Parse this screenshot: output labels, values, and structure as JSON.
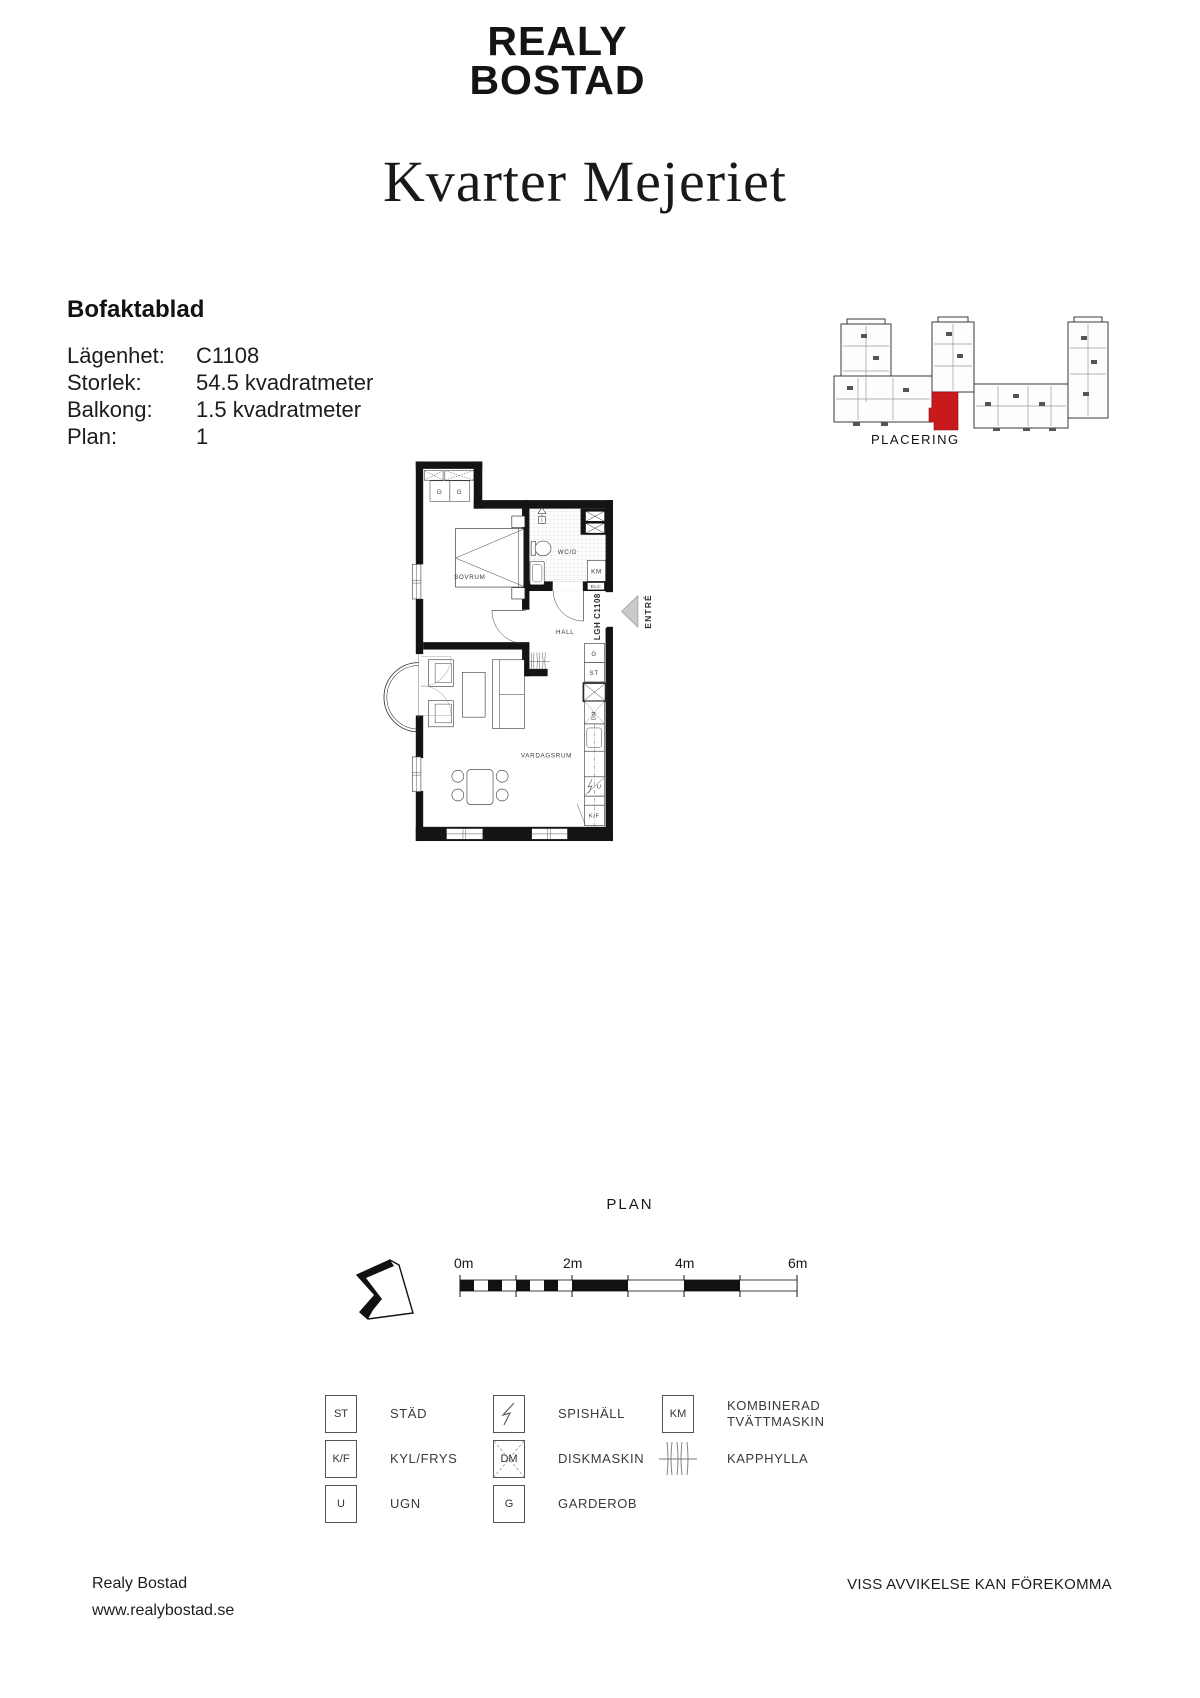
{
  "page": {
    "background": "#ffffff",
    "ink": "#111111",
    "accent_red": "#c8191c"
  },
  "header": {
    "logo_line1": "REALY",
    "logo_line2": "BOSTAD",
    "title": "Kvarter Mejeriet"
  },
  "factsheet": {
    "heading": "Bofaktablad",
    "rows": [
      {
        "label": "Lägenhet:",
        "value": "C1108"
      },
      {
        "label": "Storlek:",
        "value": "54.5 kvadratmeter"
      },
      {
        "label": "Balkong:",
        "value": "1.5 kvadratmeter"
      },
      {
        "label": "Plan:",
        "value": "1"
      }
    ]
  },
  "placement": {
    "caption": "PLACERING"
  },
  "plan": {
    "caption": "PLAN",
    "room_labels": {
      "bedroom": "SOVRUM",
      "bathroom": "WC/D",
      "hall": "HALL",
      "living_room": "VARDAGSRUM"
    },
    "unit_label": "LGH C1108",
    "entrance_label": "ENTRÉ",
    "fixture_labels": {
      "wardrobe": "G",
      "cleaning": "ST",
      "washer": "KM",
      "electrical": "ELC",
      "dishwasher": "DM",
      "oven": "U",
      "fridge_freezer": "K/F"
    }
  },
  "scale": {
    "ticks": [
      "0m",
      "2m",
      "4m",
      "6m"
    ],
    "label": "SKALA 1:100"
  },
  "legend": {
    "items": [
      {
        "symbol": "ST",
        "label": "STÄD"
      },
      {
        "symbol": "K/F",
        "label": "KYL/FRYS"
      },
      {
        "symbol": "U",
        "label": "UGN"
      },
      {
        "symbol": "spishall-icon",
        "label": "SPISHÄLL"
      },
      {
        "symbol": "DM",
        "label": "DISKMASKIN"
      },
      {
        "symbol": "G",
        "label": "GARDEROB"
      },
      {
        "symbol": "KM",
        "label": "KOMBINERAD TVÄTTMASKIN"
      },
      {
        "symbol": "kapphylla-icon",
        "label": "KAPPHYLLA"
      }
    ]
  },
  "footer": {
    "company": "Realy Bostad",
    "website": "www.realybostad.se",
    "disclaimer": "VISS AVVIKELSE KAN FÖREKOMMA"
  }
}
